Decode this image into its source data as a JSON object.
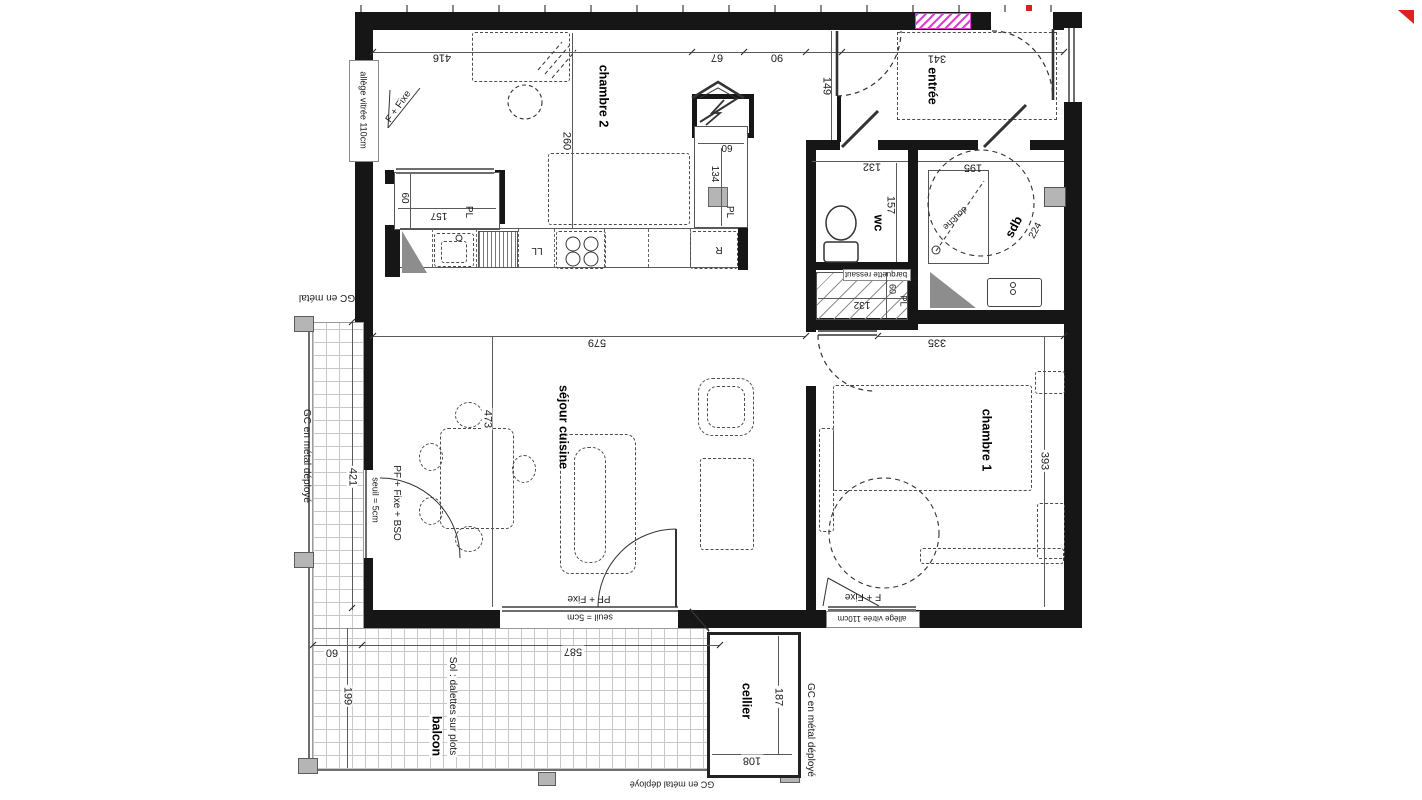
{
  "colors": {
    "wall": "#161616",
    "line": "#5a5a5a",
    "furniture": "#4c4c4c",
    "grid": "#c8c8c8",
    "gray": "#b5b5b5",
    "pink": "#df3fd0",
    "red": "#e02020"
  },
  "rooms": {
    "chambre2": "chambre 2",
    "entree": "entrée",
    "wc": "wc",
    "sdb": "sdb",
    "chambre1": "chambre 1",
    "sejour": "séjour cuisine",
    "cellier": "cellier",
    "balcon": "balcon"
  },
  "dims": {
    "top_left": "416",
    "top_mid1": "67",
    "top_mid2": "90",
    "entree_width": "341",
    "entree_depth": "149",
    "chambre2_depth": "260",
    "closet2_depth": "60",
    "closet2_width": "157",
    "niche_width": "60",
    "niche_depth": "134",
    "wc_width": "132",
    "wc_depth": "157",
    "sdb_width": "195",
    "sdb_depth": "224",
    "placard_width": "132",
    "placard_depth": "60",
    "placard_offset": "25",
    "sejour_width": "579",
    "couloir_width": "335",
    "sejour_depth": "473",
    "chambre1_depth": "393",
    "balcon_side_length": "421",
    "balcon_strip_width": "60",
    "balcon_width": "587",
    "balcon_depth": "199",
    "cellier_depth": "187",
    "cellier_width": "108"
  },
  "annotations": {
    "allege_gauche": "allège vitrée 110cm",
    "allege_bas": "allège vitrée 110cm",
    "f_fixe_haut": "F + Fixe",
    "f_fixe_bas": "F + Fixe",
    "pf_fixe": "PF + Fixe",
    "pf_fixe_bso": "PF + Fixe + BSO",
    "seuil_gauche": "seuil ≈ 5cm",
    "seuil_bas": "seuil = 5cm",
    "gc_metal": "GC en métal",
    "gc_deploye_gauche": "GC en métal déployé",
    "gc_deploye_droit": "GC en métal déployé",
    "gc_deploye_bas": "GC en métal déployé",
    "sol": "Sol : dalettes sur plots",
    "barquette": "barquette ressaut",
    "douche": "douche",
    "pl": "PL",
    "ll": "LL",
    "r": "R"
  }
}
